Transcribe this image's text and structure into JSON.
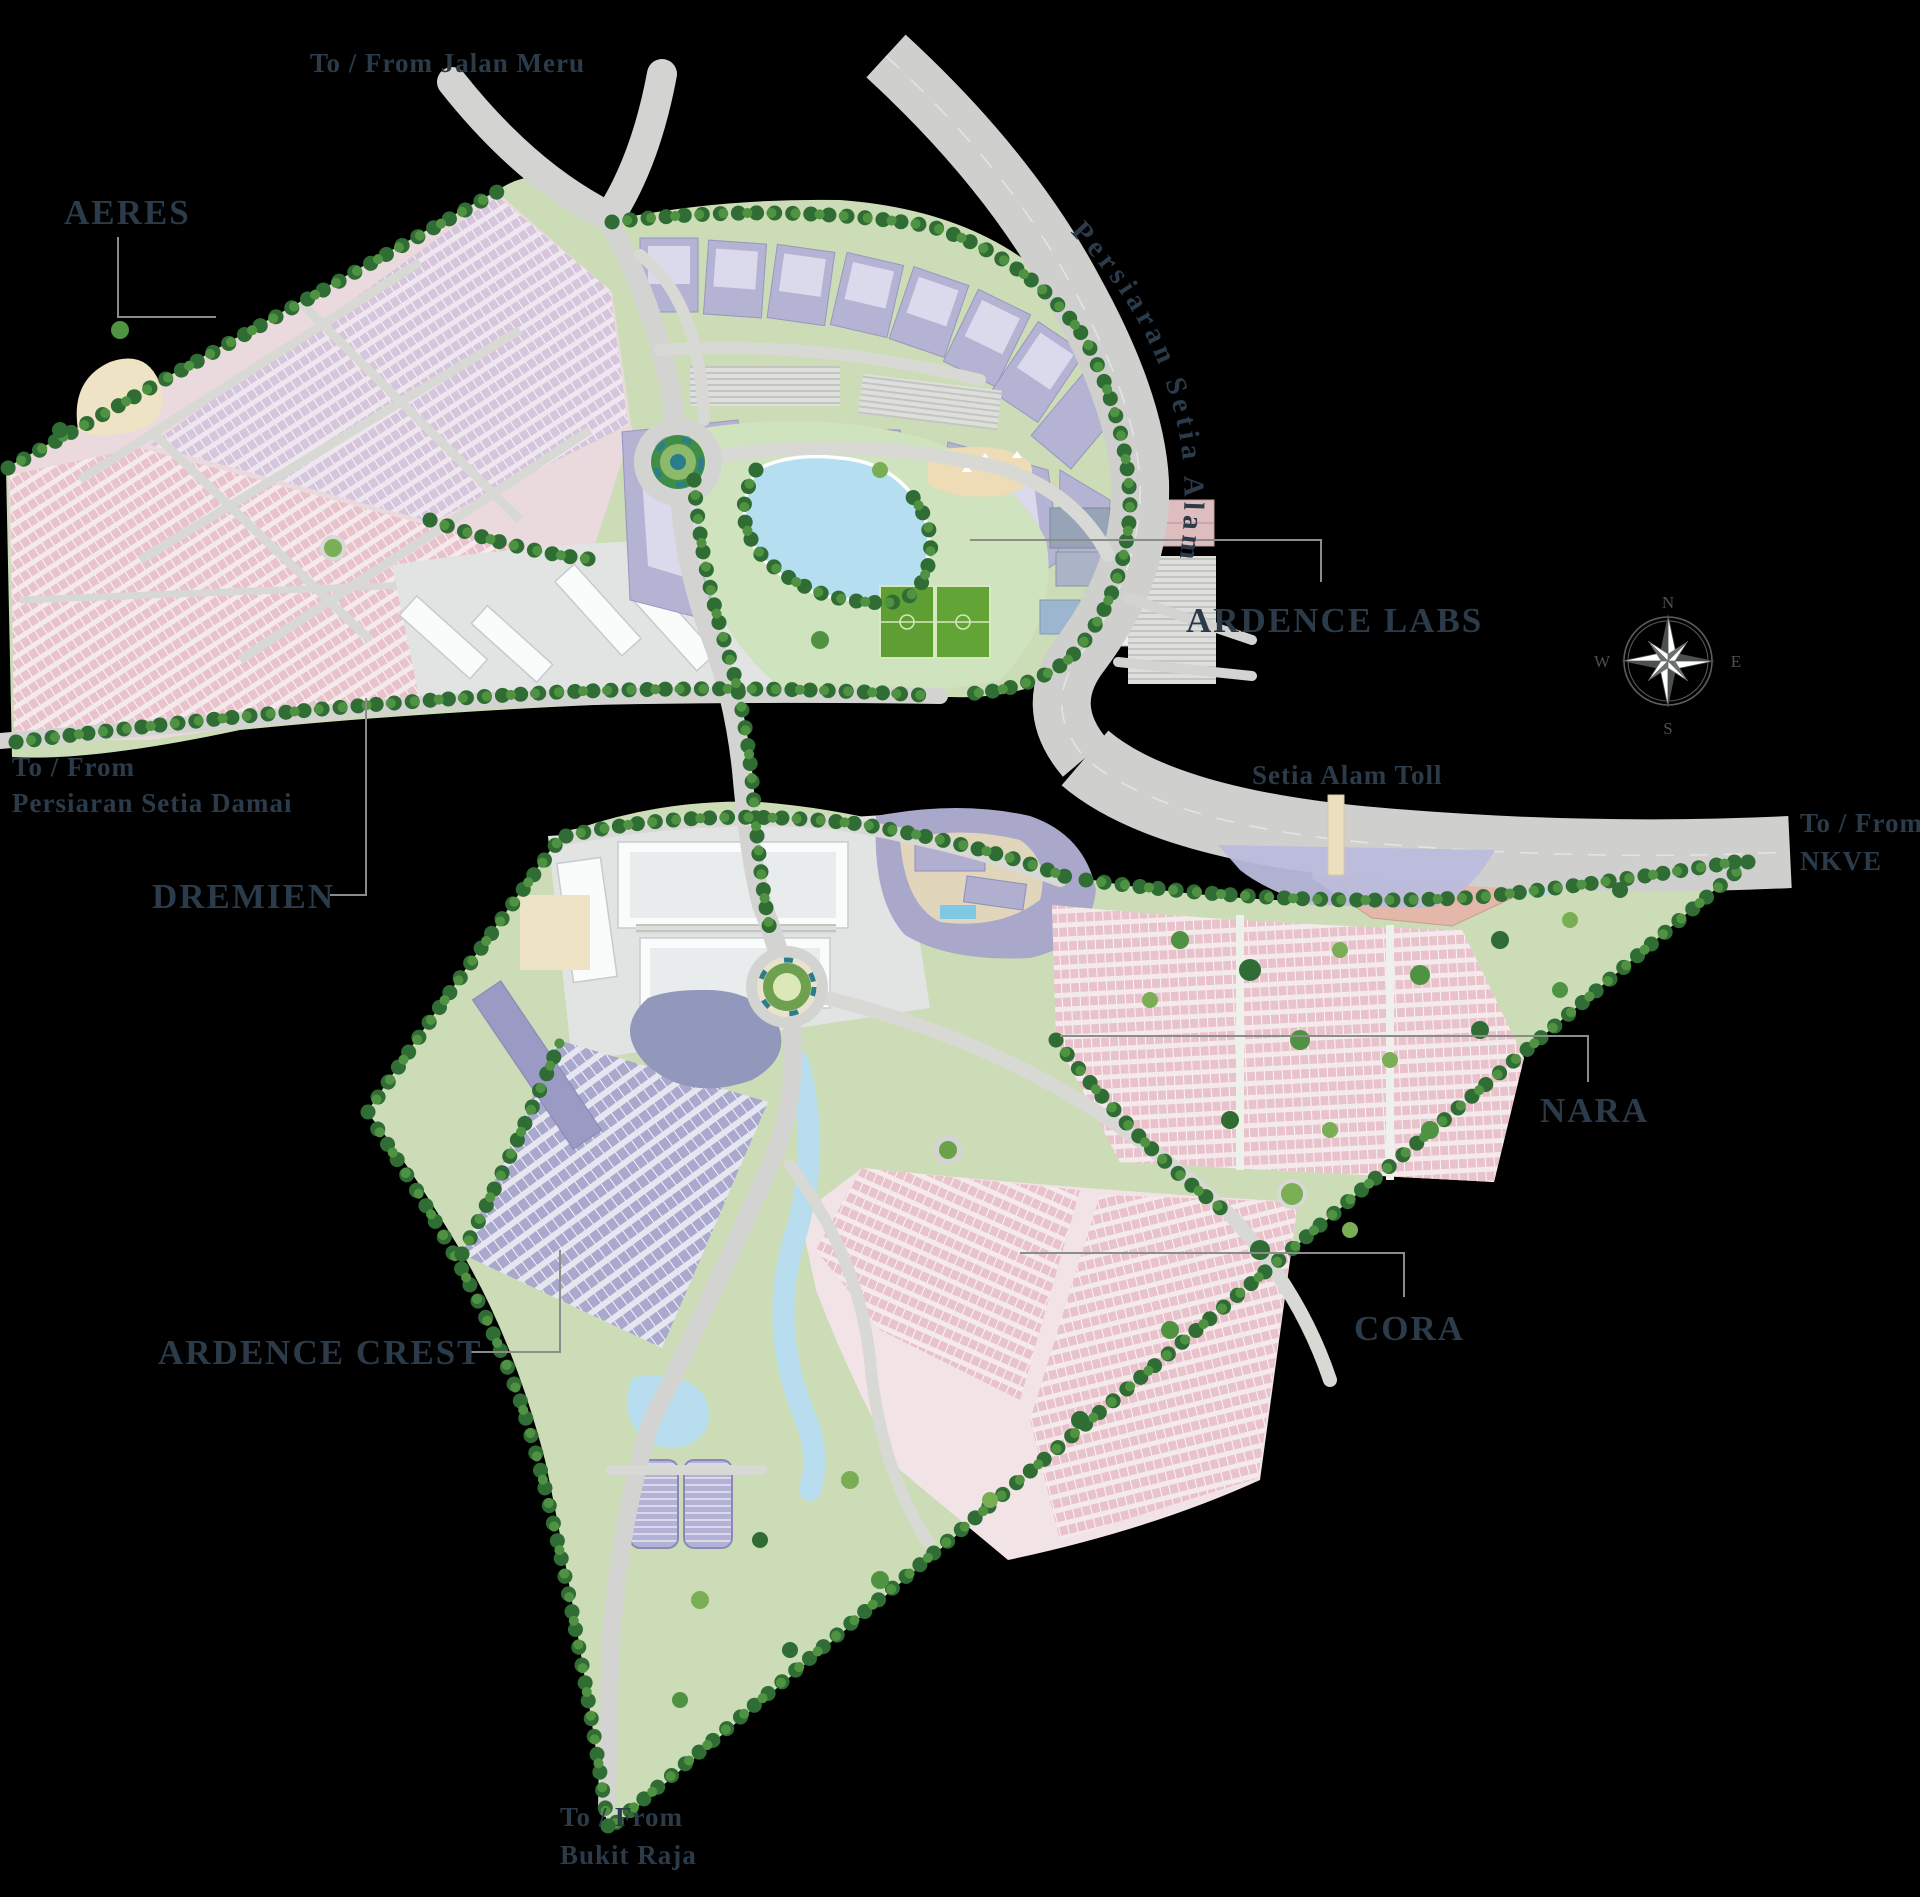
{
  "map": {
    "road_labels": {
      "jalan_meru": "To / From Jalan Meru",
      "persiaran_setia_alam": "Persiaran Setia Alam",
      "setia_damai_line1": "To / From",
      "setia_damai_line2": "Persiaran Setia Damai",
      "setia_alam_toll": "Setia Alam Toll",
      "nkve_line1": "To / From",
      "nkve_line2": "NKVE",
      "bukit_raja_line1": "To / From",
      "bukit_raja_line2": "Bukit Raja"
    },
    "region_labels": {
      "aeres": "AERES",
      "dremien": "DREMIEN",
      "ardence_labs": "ARDENCE LABS",
      "ardence_crest": "ARDENCE CREST",
      "nara": "NARA",
      "cora": "CORA"
    },
    "compass": {
      "n": "N",
      "e": "E",
      "s": "S",
      "w": "W"
    },
    "colors": {
      "background": "#000000",
      "label_text": "#2b3b49",
      "leader_line": "#8a8d8a",
      "road": "#d3d4d1",
      "highway": "#cfd0cd",
      "land_green": "#cbdcb6",
      "park_green": "#cfe3bf",
      "tree_dark": "#2f6d34",
      "tree_mid": "#4f9342",
      "water": "#b5ddef",
      "lake_dark": "#9298bb",
      "housing_pink": "#e9c3cb",
      "housing_mauve": "#d6c6dc",
      "building_lavender": "#b4b3d3",
      "warehouse_purple": "#a9a8cd",
      "industrial_gray": "#e2e4e3",
      "toll_plaza": "#babadc",
      "toll_gantry": "#ecdfc0",
      "pitch_green": "#5f9e33",
      "beige": "#eddcb6"
    }
  }
}
